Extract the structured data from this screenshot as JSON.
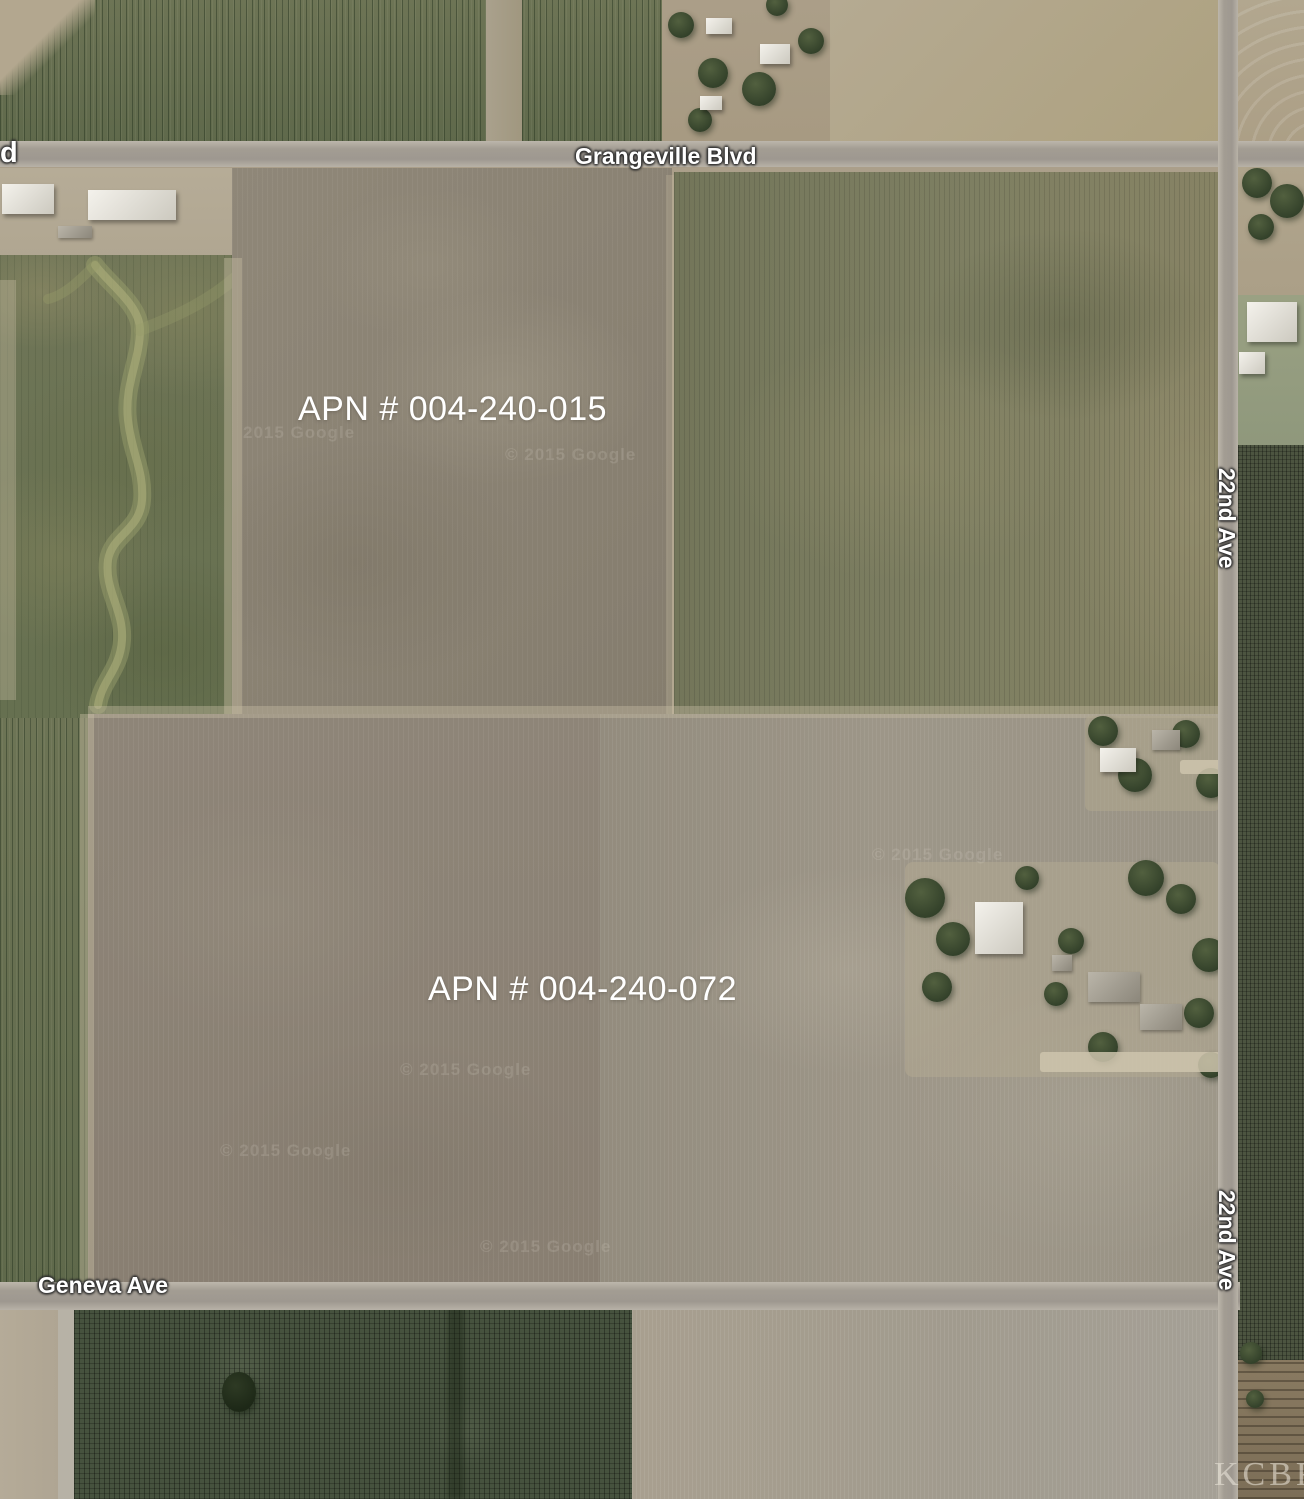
{
  "image_type": "satellite parcel map",
  "parcels": [
    {
      "apn_label": "APN # 004-240-015"
    },
    {
      "apn_label": "APN # 004-240-072"
    }
  ],
  "roads": {
    "grangeville": "Grangeville Blvd",
    "left_edge_partial": "d",
    "twenty_second_upper": "22nd Ave",
    "twenty_second_lower": "22nd Ave",
    "geneva": "Geneva Ave"
  },
  "watermarks": {
    "google": "© 2015 Google",
    "google_partial": "2015 Google",
    "brand": "KCBR"
  },
  "colors": {
    "label_text": "#ffffff",
    "road_surface": "#a39d93",
    "plowed_field_brown": "#8a8274",
    "crop_field_olive": "#7b7c60",
    "orchard_dark_green": "#46523e",
    "bare_field_tan": "#b2a78f"
  }
}
